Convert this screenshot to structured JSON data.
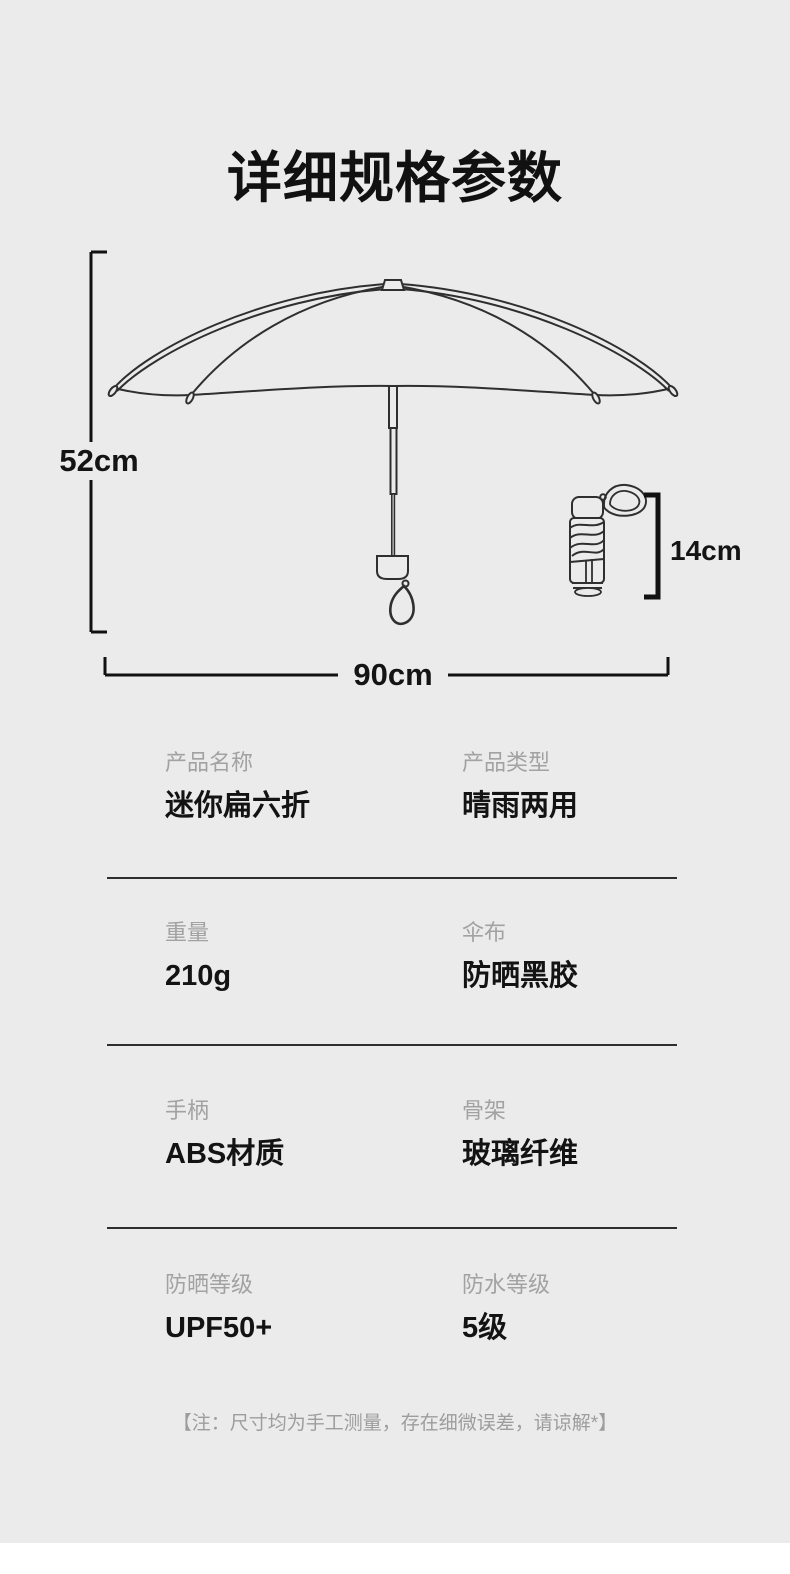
{
  "page": {
    "title": "详细规格参数",
    "note": "【注：尺寸均为手工测量，存在细微误差，请谅解*】",
    "background_color": "#ebebeb",
    "line_color": "#2f2f2f",
    "label_color": "#a2a2a2",
    "value_color": "#131313"
  },
  "diagram": {
    "open_height_label": "52cm",
    "open_width_label": "90cm",
    "folded_height_label": "14cm"
  },
  "specs": {
    "rows": [
      {
        "left": {
          "label": "产品名称",
          "value": "迷你扁六折"
        },
        "right": {
          "label": "产品类型",
          "value": "晴雨两用"
        }
      },
      {
        "left": {
          "label": "重量",
          "value": "210g"
        },
        "right": {
          "label": "伞布",
          "value": "防晒黑胶"
        }
      },
      {
        "left": {
          "label": "手柄",
          "value": "ABS材质"
        },
        "right": {
          "label": "骨架",
          "value": "玻璃纤维"
        }
      },
      {
        "left": {
          "label": "防晒等级",
          "value": "UPF50+"
        },
        "right": {
          "label": "防水等级",
          "value": "5级"
        }
      }
    ]
  }
}
